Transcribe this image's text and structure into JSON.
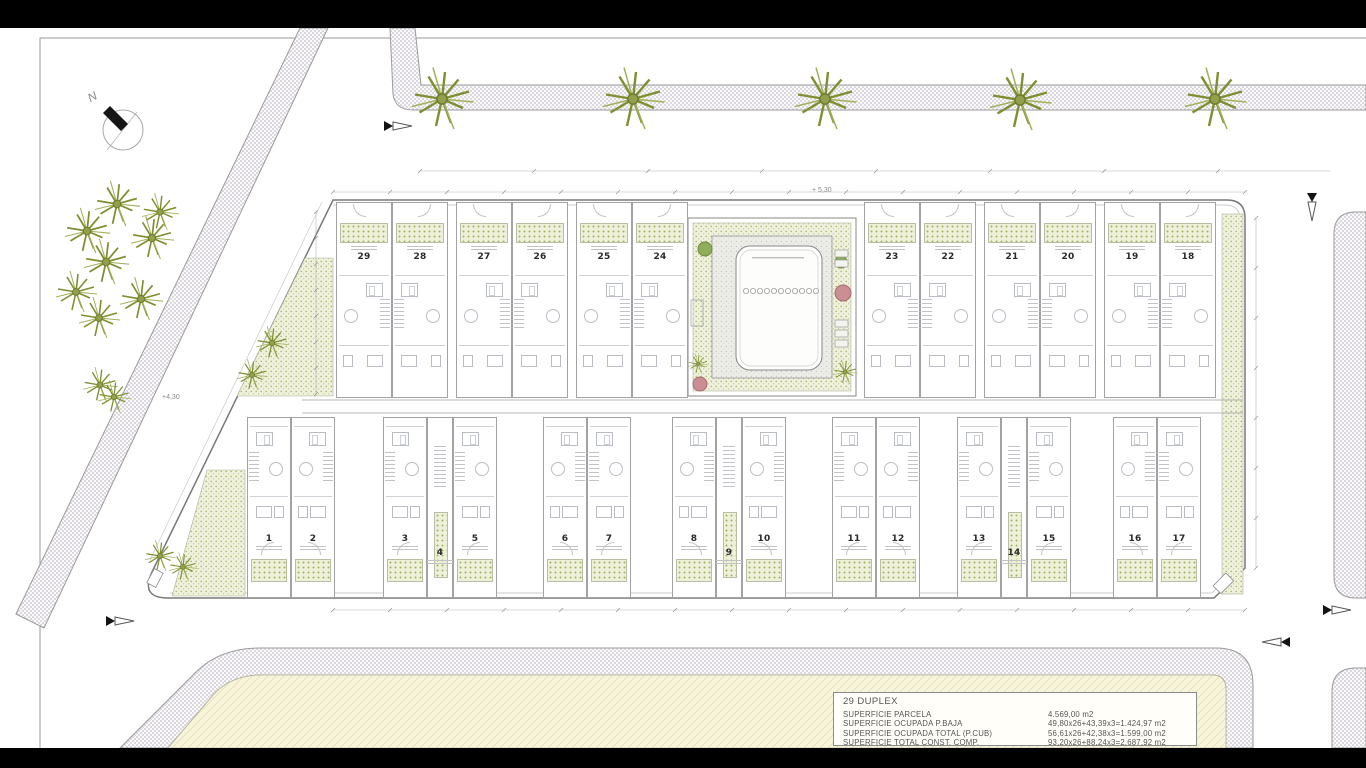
{
  "drawing_type": "architectural site plan",
  "north": {
    "label": "N"
  },
  "units": {
    "top_row": [
      "29",
      "28",
      "27",
      "26",
      "25",
      "24",
      "23",
      "22",
      "21",
      "20",
      "19",
      "18"
    ],
    "bottom_row": [
      "1",
      "2",
      "3",
      "4",
      "5",
      "6",
      "7",
      "8",
      "9",
      "10",
      "11",
      "12",
      "13",
      "14",
      "15",
      "16",
      "17"
    ]
  },
  "annotations": {
    "level_top": "+ 5,30",
    "level_left": "+4,30"
  },
  "legend": {
    "title": "29 DUPLEX",
    "rows": [
      {
        "label": "SUPERFICIE PARCELA",
        "value": "4.569,00 m2"
      },
      {
        "label": "SUPERFICIE OCUPADA P.BAJA",
        "value": "49,80x26+43,39x3=1.424,97 m2"
      },
      {
        "label": "SUPERFICIE OCUPADA TOTAL (P.CUB)",
        "value": "56,61x26+42,38x3=1.599,00 m2"
      },
      {
        "label": "SUPERFICIE TOTAL CONST. COMP.",
        "value": "93,20x26+88,24x3=2.687,92 m2"
      }
    ]
  },
  "colors": {
    "paper": "#ffffff",
    "letterbox": "#000000",
    "line": "#8a8a8a",
    "road_hatch": "#d9d4dc",
    "palm_green": "#7d8f2f",
    "planter_green": "#eef0da",
    "south_parcel_cream": "#f7f4da",
    "plant_red": "#c98f92"
  }
}
